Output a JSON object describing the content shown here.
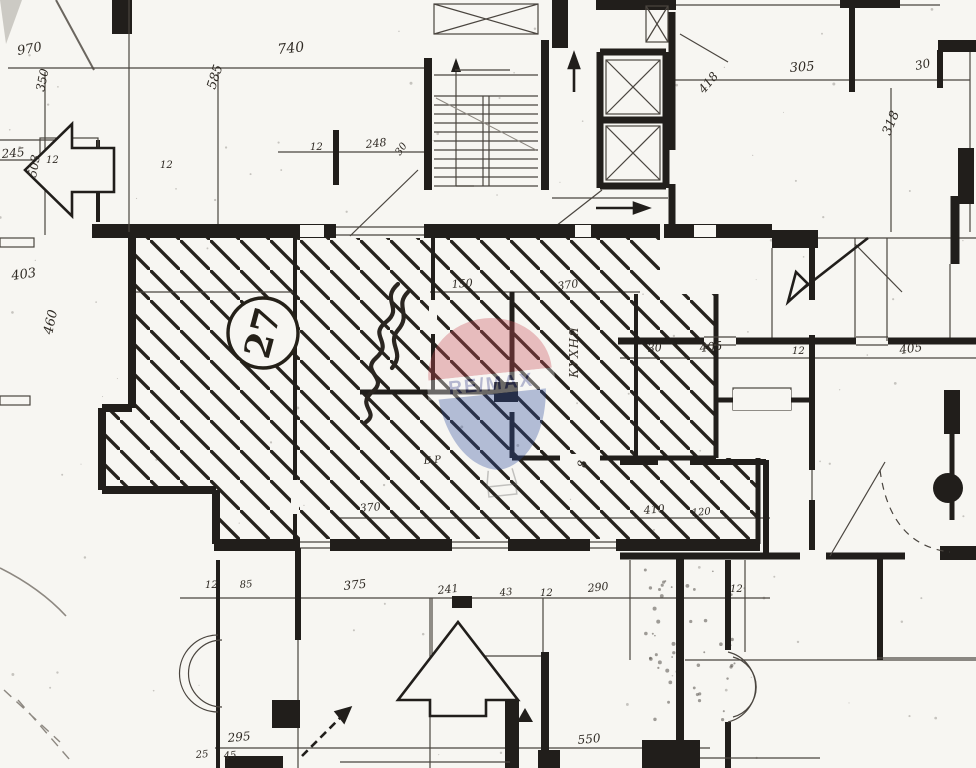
{
  "plan": {
    "ink_color": "#211e1b",
    "paper_color": "#f7f6f2",
    "unit": {
      "number": "27"
    },
    "room_label_vertical": "КУХНЯ",
    "dimension_labels": [
      {
        "t": "970",
        "x": 18,
        "y": 55,
        "r": -10,
        "s": 13
      },
      {
        "t": "350",
        "x": 44,
        "y": 92,
        "r": -78,
        "s": 12
      },
      {
        "t": "245",
        "x": 2,
        "y": 158,
        "r": -5,
        "s": 12
      },
      {
        "t": "12",
        "x": 46,
        "y": 163,
        "r": 0,
        "s": 10
      },
      {
        "t": "503",
        "x": 36,
        "y": 178,
        "r": -80,
        "s": 12
      },
      {
        "t": "740",
        "x": 278,
        "y": 54,
        "r": -6,
        "s": 14
      },
      {
        "t": "585",
        "x": 215,
        "y": 90,
        "r": -72,
        "s": 13
      },
      {
        "t": "12",
        "x": 160,
        "y": 168,
        "r": 0,
        "s": 10
      },
      {
        "t": "12",
        "x": 310,
        "y": 150,
        "r": 0,
        "s": 10
      },
      {
        "t": "248",
        "x": 366,
        "y": 148,
        "r": -6,
        "s": 11
      },
      {
        "t": "30",
        "x": 400,
        "y": 156,
        "r": -55,
        "s": 10
      },
      {
        "t": "403",
        "x": 12,
        "y": 280,
        "r": -8,
        "s": 13
      },
      {
        "t": "460",
        "x": 52,
        "y": 335,
        "r": -78,
        "s": 13
      },
      {
        "t": "305",
        "x": 790,
        "y": 72,
        "r": -4,
        "s": 13
      },
      {
        "t": "30",
        "x": 916,
        "y": 70,
        "r": -12,
        "s": 12
      },
      {
        "t": "418",
        "x": 704,
        "y": 94,
        "r": -50,
        "s": 12
      },
      {
        "t": "318",
        "x": 890,
        "y": 136,
        "r": -68,
        "s": 13
      },
      {
        "t": "150",
        "x": 452,
        "y": 288,
        "r": -4,
        "s": 11
      },
      {
        "t": "370",
        "x": 558,
        "y": 290,
        "r": -8,
        "s": 11
      },
      {
        "t": "30",
        "x": 648,
        "y": 352,
        "r": -4,
        "s": 11
      },
      {
        "t": "405",
        "x": 700,
        "y": 352,
        "r": -6,
        "s": 12
      },
      {
        "t": "12",
        "x": 792,
        "y": 354,
        "r": 0,
        "s": 10
      },
      {
        "t": "405",
        "x": 900,
        "y": 354,
        "r": -8,
        "s": 12
      },
      {
        "t": "370",
        "x": 360,
        "y": 512,
        "r": -5,
        "s": 11
      },
      {
        "t": "410",
        "x": 644,
        "y": 514,
        "r": -5,
        "s": 11
      },
      {
        "t": "120",
        "x": 692,
        "y": 516,
        "r": -5,
        "s": 10
      },
      {
        "t": "12",
        "x": 205,
        "y": 588,
        "r": 0,
        "s": 10
      },
      {
        "t": "85",
        "x": 240,
        "y": 588,
        "r": -5,
        "s": 10
      },
      {
        "t": "375",
        "x": 344,
        "y": 590,
        "r": -6,
        "s": 12
      },
      {
        "t": "241",
        "x": 438,
        "y": 594,
        "r": -6,
        "s": 11
      },
      {
        "t": "43",
        "x": 500,
        "y": 596,
        "r": -6,
        "s": 10
      },
      {
        "t": "12",
        "x": 540,
        "y": 596,
        "r": 0,
        "s": 10
      },
      {
        "t": "290",
        "x": 588,
        "y": 592,
        "r": -6,
        "s": 11
      },
      {
        "t": "12",
        "x": 730,
        "y": 592,
        "r": 0,
        "s": 10
      },
      {
        "t": "295",
        "x": 228,
        "y": 742,
        "r": -5,
        "s": 12
      },
      {
        "t": "25",
        "x": 196,
        "y": 758,
        "r": -5,
        "s": 10
      },
      {
        "t": "45",
        "x": 224,
        "y": 759,
        "r": -5,
        "s": 10
      },
      {
        "t": "550",
        "x": 578,
        "y": 744,
        "r": -5,
        "s": 12
      },
      {
        "t": "8",
        "x": 586,
        "y": 468,
        "r": -85,
        "s": 12
      },
      {
        "t": "Б.Р",
        "x": 424,
        "y": 464,
        "r": -5,
        "s": 10
      }
    ]
  },
  "watermark": {
    "brand": "RE/MAX",
    "top_color": "#c94f58",
    "band_color": "#fafafa",
    "bottom_color": "#2f4e9e"
  }
}
